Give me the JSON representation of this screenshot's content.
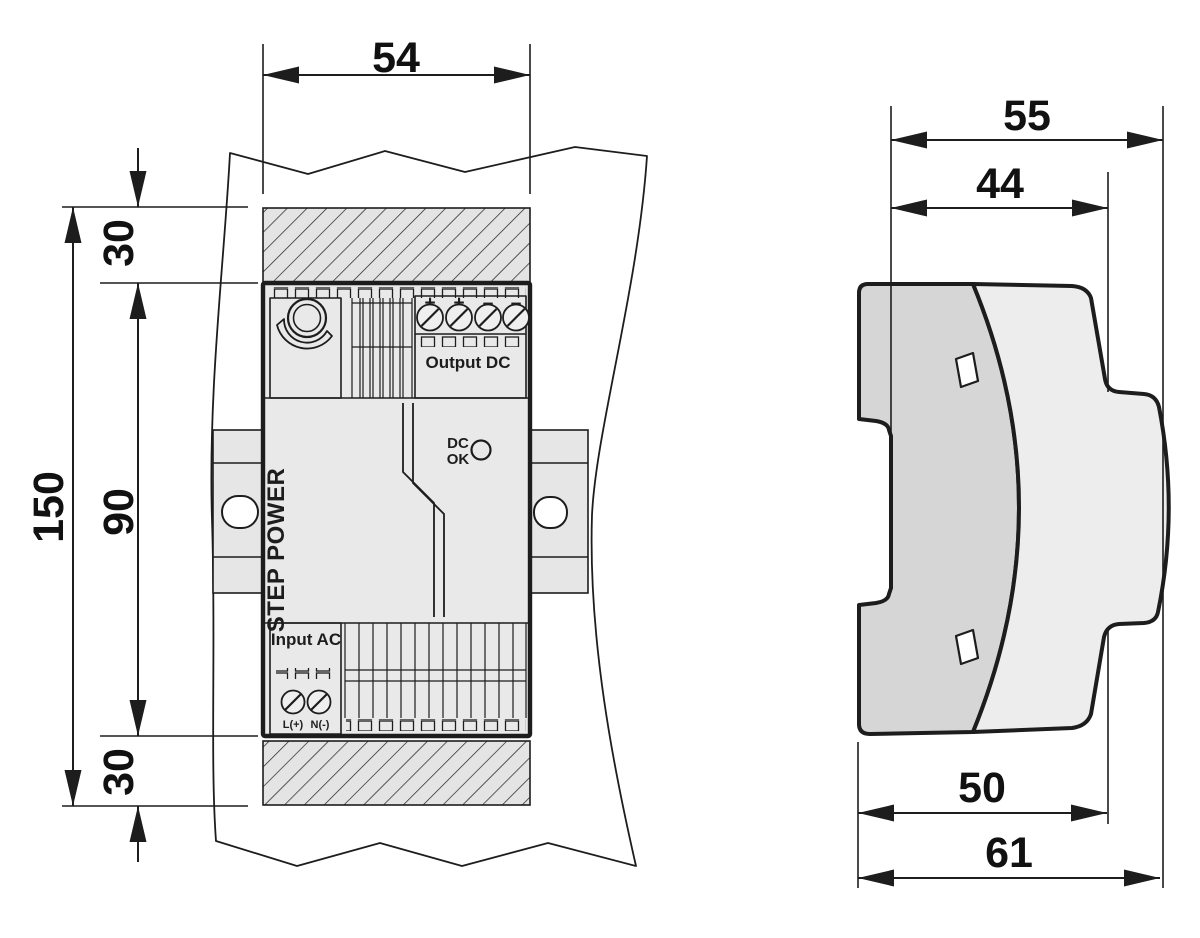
{
  "front_view": {
    "dimensions": {
      "width_mm": "54",
      "total_height_mm": "150",
      "body_height_mm": "90",
      "top_clearance_mm": "30",
      "bottom_clearance_mm": "30"
    },
    "device": {
      "brand": "STEP POWER",
      "output_section_label": "Output DC",
      "input_section_label": "Input AC",
      "dc_ok_line1": "DC",
      "dc_ok_line2": "OK",
      "output_terminals": [
        "+",
        "+",
        "–",
        "–"
      ],
      "input_terminals": [
        "L(+)",
        "N(-)"
      ]
    }
  },
  "side_view": {
    "dimensions": {
      "overall_width_mm": "55",
      "housing_width_mm": "44",
      "front_depth_mm": "50",
      "total_depth_mm": "61"
    }
  },
  "colors": {
    "line": "#1d1d1d",
    "device_fill": "#e9e9e9",
    "hatch_fill": "#e4e4e4",
    "side_rear_fill": "#d6d6d6",
    "side_front_fill": "#ededed"
  }
}
